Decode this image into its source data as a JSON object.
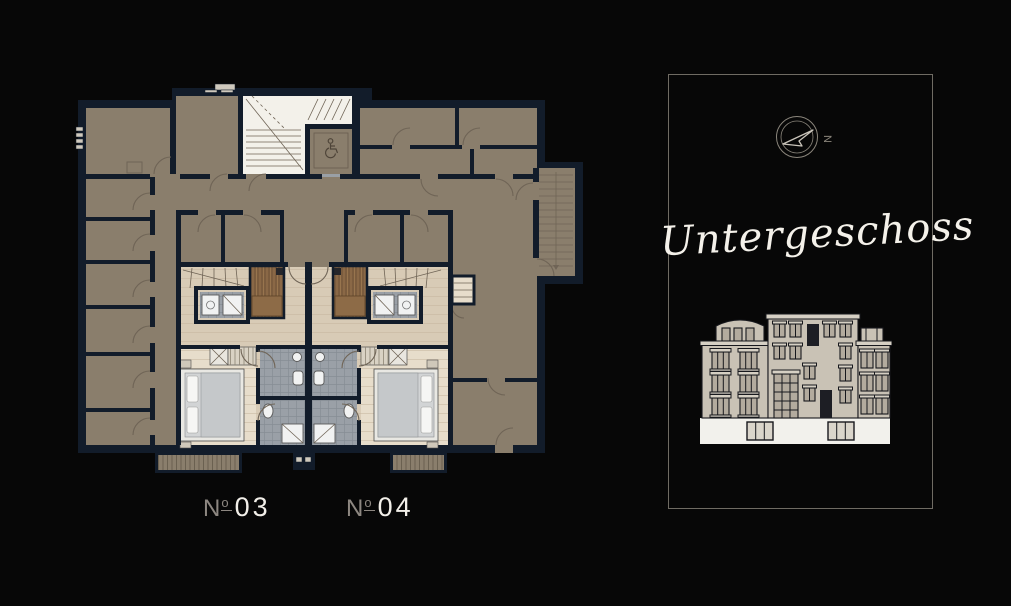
{
  "page": {
    "background": "#070707"
  },
  "floor_plan": {
    "colors": {
      "wall": "#121c2a",
      "common_floor": "#8a7e6c",
      "wood_floor": "#d8cbb6",
      "wood_light": "#e7ddcb",
      "tile": "#9aa0a7",
      "sauna": "#7b5c3e",
      "stairwell_white": "#f3f1ea",
      "door_stroke": "#6f6456"
    },
    "units": [
      {
        "id": "unit-03",
        "prefix": "N",
        "ordinal": "o",
        "number": "03"
      },
      {
        "id": "unit-04",
        "prefix": "N",
        "ordinal": "o",
        "number": "04"
      }
    ],
    "icons": {
      "accessible_icon": "wheelchair-symbol-in-elevator"
    }
  },
  "panel": {
    "title": "Untergeschoss",
    "compass_letter": "N",
    "border_color": "#6f6b63",
    "text_color": "#f4f1ea",
    "elevation": {
      "highlight_color": "#f2f1ec",
      "facade_color": "#c9c2b5"
    }
  }
}
